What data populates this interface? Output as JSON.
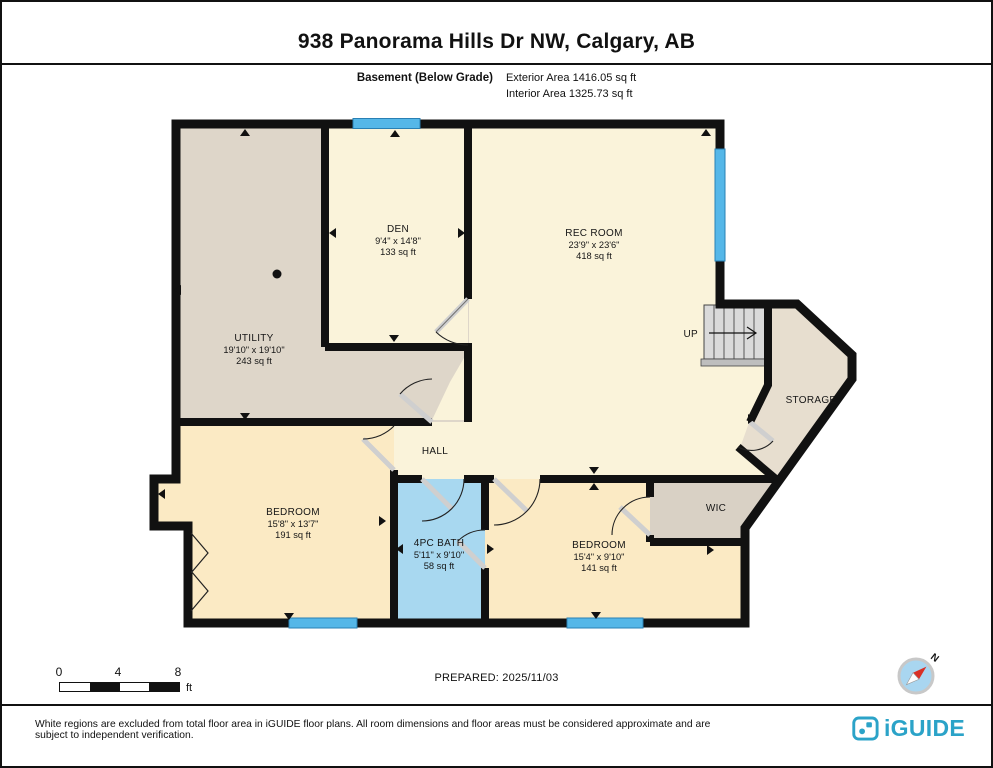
{
  "header": {
    "title": "938 Panorama Hills Dr NW, Calgary, AB",
    "floor_label": "Basement (Below Grade)",
    "exterior_area": "Exterior Area 1416.05 sq ft",
    "interior_area": "Interior Area 1325.73 sq ft"
  },
  "rooms": [
    {
      "name": "DEN",
      "dims": "9'4\" x 14'8\"",
      "area": "133 sq ft"
    },
    {
      "name": "REC ROOM",
      "dims": "23'9\" x 23'6\"",
      "area": "418 sq ft"
    },
    {
      "name": "UTILITY",
      "dims": "19'10\" x 19'10\"",
      "area": "243 sq ft"
    },
    {
      "name": "HALL"
    },
    {
      "name": "BEDROOM",
      "dims": "15'8\" x 13'7\"",
      "area": "191 sq ft"
    },
    {
      "name": "4PC BATH",
      "dims": "5'11\" x 9'10\"",
      "area": "58 sq ft"
    },
    {
      "name": "BEDROOM",
      "dims": "15'4\" x 9'10\"",
      "area": "141 sq ft"
    },
    {
      "name": "STORAGE"
    },
    {
      "name": "WIC"
    },
    {
      "name": "UP"
    }
  ],
  "footer": {
    "prepared_label": "PREPARED: 2025/11/03",
    "scale": {
      "ticks": [
        "0",
        "4",
        "8"
      ],
      "unit": "ft"
    },
    "compass_label": "N",
    "disclaimer": "White regions are excluded from total floor area in iGUIDE floor plans. All room dimensions and floor areas must be considered approximate and are subject to independent verification.",
    "brand": "iGUIDE"
  },
  "colors": {
    "wall": "#111111",
    "floor_cream": "#FAF3DA",
    "floor_gray": "#DED6C9",
    "floor_tan": "#E7DECF",
    "floor_wic": "#D9D1C5",
    "floor_peach": "#FBEAC4",
    "bath_blue": "#A8D8F0",
    "window_blue": "#55B7E8",
    "stairs_gray": "#DADADA",
    "brand_teal": "#2BA3C8",
    "compass_blue": "#A9D6F0",
    "compass_red": "#D93025"
  }
}
